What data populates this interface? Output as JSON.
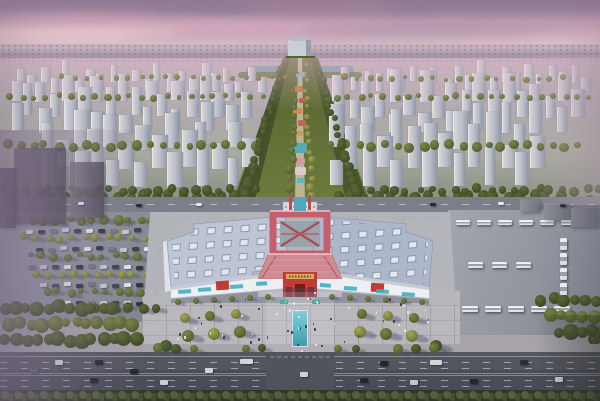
{
  "seed": 7,
  "palette": {
    "skyTop": "#a9859d",
    "sky2": "#c9a4b8",
    "sky3": "#dcb8c6",
    "skyHorizon": "#e9d2d6",
    "cloudDark": "#857c9b",
    "cloudPink": "#e3b0c2",
    "cloudGlow": "#f2dcd8",
    "farCity": "#b2a3b1",
    "horizonBand": "#998a9e",
    "cityBase1": "#b5a8b3",
    "cityBase2": "#a8a9a0",
    "cityBase3": "#82887a",
    "towerLight": "#dcdadc",
    "towerMid": "#b8bcc6",
    "towerDark": "#8f96a6",
    "roadUpper": "#7a7f8a",
    "roadDark": "#4b4f58",
    "laneWhite": "#e8e9ec",
    "plaza": "#bab8bd",
    "plazaLine": "#a2a0a8",
    "sidewalk": "#a9a7ad",
    "wall": "#edeff3",
    "roofL": "#bcc4d6",
    "roofR": "#adb7cb",
    "skylight": "#e2e6ef",
    "skylightEdge": "#7f8798",
    "redFrame": "#c4606c",
    "redRoof": "#cf8a92",
    "redRoofHi": "#eec2c6",
    "redWall": "#c23c36",
    "gold": "#d8ac60",
    "doorDark": "#701d1c",
    "lake": "#6f9cab",
    "pond": "#55a6bb",
    "pool": "#5ec0cf",
    "poolDeep": "#3e9cae",
    "carWhite": "#e6e8ec",
    "carDark": "#272b35",
    "busWhite": "#dfe3e8",
    "hazePurple": "rgba(136,117,149,0.55)",
    "shadow": "rgba(68,73,98,0.4)"
  },
  "scenery": {
    "clouds": [
      {
        "x": -40,
        "y": 0,
        "w": 300,
        "h": 16,
        "c": "cloudDark",
        "o": 0.55
      },
      {
        "x": 180,
        "y": 6,
        "w": 260,
        "h": 12,
        "c": "cloudDark",
        "o": 0.45
      },
      {
        "x": 380,
        "y": -2,
        "w": 240,
        "h": 18,
        "c": "cloudDark",
        "o": 0.5
      },
      {
        "x": 40,
        "y": 20,
        "w": 360,
        "h": 10,
        "c": "cloudPink",
        "o": 0.6
      },
      {
        "x": 300,
        "y": 24,
        "w": 280,
        "h": 10,
        "c": "cloudDark",
        "o": 0.35
      },
      {
        "x": -20,
        "y": 28,
        "w": 200,
        "h": 9,
        "c": "cloudGlow",
        "o": 0.75
      },
      {
        "x": 120,
        "y": 34,
        "w": 420,
        "h": 7,
        "c": "cloudDark",
        "o": 0.3
      },
      {
        "x": 0,
        "y": 12,
        "w": 160,
        "h": 9,
        "c": "cloudPink",
        "o": 0.5
      }
    ],
    "towerClusters": [
      {
        "x": 15,
        "y": 80,
        "cols": 11,
        "rows": 2,
        "dx": 23,
        "dy": 10,
        "w": 8,
        "h": 15
      },
      {
        "x": 338,
        "y": 80,
        "cols": 11,
        "rows": 2,
        "dx": 23,
        "dy": 10,
        "w": 8,
        "h": 15
      },
      {
        "x": 8,
        "y": 100,
        "cols": 9,
        "rows": 3,
        "dx": 27,
        "dy": 15,
        "w": 11,
        "h": 24
      },
      {
        "x": 332,
        "y": 100,
        "cols": 9,
        "rows": 3,
        "dx": 28,
        "dy": 15,
        "w": 11,
        "h": 24
      },
      {
        "x": 40,
        "y": 147,
        "cols": 7,
        "rows": 3,
        "dx": 31,
        "dy": 19,
        "w": 13,
        "h": 32
      },
      {
        "x": 328,
        "y": 147,
        "cols": 7,
        "rows": 3,
        "dx": 31,
        "dy": 19,
        "w": 13,
        "h": 32
      }
    ],
    "cityTreeRows": [
      {
        "x0": 8,
        "y0": 97,
        "n": 22,
        "dx": 12,
        "r": 3,
        "t": "olive"
      },
      {
        "x0": 334,
        "y0": 97,
        "n": 22,
        "dx": 12,
        "r": 3,
        "t": "olive"
      },
      {
        "x0": 4,
        "y0": 146,
        "n": 20,
        "dx": 13,
        "r": 4,
        "t": "olive"
      },
      {
        "x0": 330,
        "y0": 146,
        "n": 20,
        "dx": 13,
        "r": 4,
        "t": "olive"
      },
      {
        "x0": 24,
        "y0": 196,
        "n": 18,
        "dx": 13,
        "r": 5,
        "t": "dark"
      },
      {
        "x0": 336,
        "y0": 196,
        "n": 18,
        "dx": 13,
        "r": 5,
        "t": "dark"
      },
      {
        "x0": 0,
        "y0": 190,
        "n": 22,
        "dx": 12,
        "r": 4,
        "t": "dark"
      },
      {
        "x0": 356,
        "y0": 190,
        "n": 21,
        "dx": 12,
        "r": 4,
        "t": "dark"
      },
      {
        "x0": 148,
        "y0": 216,
        "n": 9,
        "dx": 12,
        "r": 4,
        "t": "olive"
      },
      {
        "x0": 352,
        "y0": 216,
        "n": 9,
        "dx": 12,
        "r": 4,
        "t": "olive"
      },
      {
        "x0": 60,
        "y0": 78,
        "n": 18,
        "dx": 13,
        "r": 2.5,
        "t": "olive"
      },
      {
        "x0": 340,
        "y0": 78,
        "n": 18,
        "dx": 13,
        "r": 2.5,
        "t": "olive"
      }
    ],
    "corridorTreeLines": [
      {
        "x1": 284,
        "y1": 60,
        "x2": 244,
        "y2": 200,
        "n": 22,
        "r0": 2,
        "r1": 5,
        "t": "dark"
      },
      {
        "x1": 316,
        "y1": 60,
        "x2": 358,
        "y2": 200,
        "n": 22,
        "r0": 2,
        "r1": 5,
        "t": "dark"
      },
      {
        "x1": 296,
        "y1": 64,
        "x2": 290,
        "y2": 196,
        "n": 16,
        "r0": 1.5,
        "r1": 4,
        "t": "olive"
      },
      {
        "x1": 305,
        "y1": 64,
        "x2": 312,
        "y2": 196,
        "n": 16,
        "r0": 1.5,
        "r1": 4,
        "t": "yellow"
      },
      {
        "x1": 468,
        "y1": 208,
        "x2": 560,
        "y2": 318,
        "n": 26,
        "r0": 5,
        "r1": 7,
        "t": "dark"
      },
      {
        "x1": 480,
        "y1": 206,
        "x2": 572,
        "y2": 316,
        "n": 24,
        "r0": 4,
        "r1": 6,
        "t": "olive"
      },
      {
        "x1": 590,
        "y1": 200,
        "x2": 594,
        "y2": 340,
        "n": 18,
        "r0": 4,
        "r1": 6,
        "t": "dark"
      }
    ],
    "parkFeatures": [
      {
        "x": 296,
        "y": 72,
        "w": 10,
        "h": 5,
        "c": "#7fb0bc"
      },
      {
        "x": 295,
        "y": 86,
        "w": 8,
        "h": 6,
        "c": "#c27a3e"
      },
      {
        "x": 299,
        "y": 98,
        "w": 7,
        "h": 5,
        "c": "#b55a4a"
      },
      {
        "x": 293,
        "y": 108,
        "w": 9,
        "h": 6,
        "c": "#cc8a50"
      },
      {
        "x": 298,
        "y": 120,
        "w": 8,
        "h": 6,
        "c": "#c06858"
      },
      {
        "x": 294,
        "y": 131,
        "w": 9,
        "h": 5,
        "c": "#cf9a5a"
      },
      {
        "x": 293,
        "y": 143,
        "w": 14,
        "h": 10,
        "c": "#58a8bc"
      },
      {
        "x": 296,
        "y": 158,
        "w": 9,
        "h": 6,
        "c": "#d898a0"
      },
      {
        "x": 295,
        "y": 167,
        "w": 11,
        "h": 8,
        "c": "#e0c8cc"
      },
      {
        "x": 297,
        "y": 178,
        "w": 8,
        "h": 5,
        "c": "#6ab0c0"
      }
    ],
    "awnings": [
      {
        "x": 178,
        "y": 290,
        "w": 13,
        "h": 4,
        "a": -4
      },
      {
        "x": 198,
        "y": 288,
        "w": 13,
        "h": 4,
        "a": -4
      },
      {
        "x": 230,
        "y": 285,
        "w": 13,
        "h": 4,
        "a": -4
      },
      {
        "x": 256,
        "y": 282,
        "w": 11,
        "h": 4,
        "a": -4
      },
      {
        "x": 320,
        "y": 283,
        "w": 11,
        "h": 4,
        "a": 4
      },
      {
        "x": 344,
        "y": 286,
        "w": 13,
        "h": 4,
        "a": 4
      },
      {
        "x": 376,
        "y": 289,
        "w": 13,
        "h": 4,
        "a": 4
      },
      {
        "x": 402,
        "y": 292,
        "w": 13,
        "h": 4,
        "a": 4
      }
    ],
    "plazaTrees": [
      {
        "x": 178,
        "y": 302,
        "r": 3,
        "t": "olive"
      },
      {
        "x": 196,
        "y": 301,
        "r": 3,
        "t": "olive"
      },
      {
        "x": 214,
        "y": 300,
        "r": 3,
        "t": "olive"
      },
      {
        "x": 232,
        "y": 299,
        "r": 3,
        "t": "olive"
      },
      {
        "x": 250,
        "y": 298,
        "r": 3,
        "t": "olive"
      },
      {
        "x": 268,
        "y": 297,
        "r": 3,
        "t": "olive"
      },
      {
        "x": 332,
        "y": 297,
        "r": 3,
        "t": "olive"
      },
      {
        "x": 350,
        "y": 298,
        "r": 3,
        "t": "olive"
      },
      {
        "x": 368,
        "y": 299,
        "r": 3,
        "t": "olive"
      },
      {
        "x": 386,
        "y": 300,
        "r": 3,
        "t": "olive"
      },
      {
        "x": 404,
        "y": 301,
        "r": 3,
        "t": "olive"
      },
      {
        "x": 422,
        "y": 302,
        "r": 3,
        "t": "olive"
      },
      {
        "x": 185,
        "y": 318,
        "r": 5,
        "t": "yellow"
      },
      {
        "x": 210,
        "y": 316,
        "r": 5,
        "t": "olive"
      },
      {
        "x": 236,
        "y": 314,
        "r": 5,
        "t": "yellow"
      },
      {
        "x": 188,
        "y": 336,
        "r": 6,
        "t": "olive"
      },
      {
        "x": 214,
        "y": 334,
        "r": 6,
        "t": "yellow"
      },
      {
        "x": 240,
        "y": 332,
        "r": 6,
        "t": "olive"
      },
      {
        "x": 166,
        "y": 346,
        "r": 6,
        "t": "dark"
      },
      {
        "x": 362,
        "y": 314,
        "r": 5,
        "t": "olive"
      },
      {
        "x": 388,
        "y": 316,
        "r": 5,
        "t": "yellow"
      },
      {
        "x": 414,
        "y": 318,
        "r": 5,
        "t": "olive"
      },
      {
        "x": 360,
        "y": 332,
        "r": 6,
        "t": "yellow"
      },
      {
        "x": 386,
        "y": 334,
        "r": 6,
        "t": "olive"
      },
      {
        "x": 412,
        "y": 336,
        "r": 6,
        "t": "yellow"
      },
      {
        "x": 436,
        "y": 346,
        "r": 6,
        "t": "dark"
      },
      {
        "x": 158,
        "y": 348,
        "r": 5,
        "t": "olive"
      },
      {
        "x": 176,
        "y": 349,
        "r": 5,
        "t": "dark"
      },
      {
        "x": 194,
        "y": 349,
        "r": 4,
        "t": "olive"
      },
      {
        "x": 246,
        "y": 349,
        "r": 4,
        "t": "olive"
      },
      {
        "x": 262,
        "y": 348,
        "r": 4,
        "t": "dark"
      },
      {
        "x": 338,
        "y": 349,
        "r": 4,
        "t": "olive"
      },
      {
        "x": 356,
        "y": 349,
        "r": 4,
        "t": "dark"
      },
      {
        "x": 398,
        "y": 349,
        "r": 5,
        "t": "olive"
      },
      {
        "x": 416,
        "y": 349,
        "r": 5,
        "t": "dark"
      },
      {
        "x": 434,
        "y": 348,
        "r": 5,
        "t": "olive"
      }
    ],
    "cornerTreeRows": [
      {
        "x0": 2,
        "y0": 308,
        "n": 12,
        "dx": 11,
        "r": 6,
        "t": "dark"
      },
      {
        "x0": 8,
        "y0": 324,
        "n": 12,
        "dx": 11,
        "r": 6,
        "t": "olive"
      },
      {
        "x0": 2,
        "y0": 340,
        "n": 13,
        "dx": 11,
        "r": 6,
        "t": "dark"
      },
      {
        "x0": 540,
        "y0": 300,
        "n": 6,
        "dx": 11,
        "r": 6,
        "t": "dark"
      },
      {
        "x0": 548,
        "y0": 316,
        "n": 5,
        "dx": 11,
        "r": 6,
        "t": "olive"
      },
      {
        "x0": 556,
        "y0": 332,
        "n": 5,
        "dx": 11,
        "r": 6,
        "t": "dark"
      }
    ],
    "parkingTreeRows": [
      {
        "x0": 6,
        "y0": 220,
        "n": 14,
        "dx": 12,
        "r": 4,
        "t": "olive"
      },
      {
        "x0": 22,
        "y0": 238,
        "n": 12,
        "dx": 12,
        "r": 3.5,
        "t": "yellow"
      },
      {
        "x0": 28,
        "y0": 256,
        "n": 12,
        "dx": 12,
        "r": 3.5,
        "t": "olive"
      },
      {
        "x0": 34,
        "y0": 274,
        "n": 11,
        "dx": 12,
        "r": 3.5,
        "t": "yellow"
      },
      {
        "x0": 44,
        "y0": 292,
        "n": 10,
        "dx": 12,
        "r": 3.5,
        "t": "olive"
      },
      {
        "x0": 56,
        "y0": 308,
        "n": 9,
        "dx": 12,
        "r": 4,
        "t": "dark"
      }
    ],
    "parkingCarRows": [
      {
        "x0": 26,
        "y0": 228,
        "n": 10,
        "dx": 12
      },
      {
        "x0": 36,
        "y0": 246,
        "n": 11,
        "dx": 12
      },
      {
        "x0": 28,
        "y0": 264,
        "n": 11,
        "dx": 12
      },
      {
        "x0": 40,
        "y0": 282,
        "n": 10,
        "dx": 12
      },
      {
        "x0": 52,
        "y0": 300,
        "n": 8,
        "dx": 12
      }
    ],
    "busRows": [
      {
        "x0": 456,
        "y0": 220,
        "n": 6,
        "dx": 21,
        "dy": 0,
        "w": 14,
        "h": 5
      },
      {
        "x0": 468,
        "y0": 262,
        "n": 3,
        "dx": 24,
        "dy": 0,
        "w": 15,
        "h": 6
      },
      {
        "x0": 462,
        "y0": 306,
        "n": 5,
        "dx": 23,
        "dy": 0,
        "w": 16,
        "h": 6
      },
      {
        "x0": 560,
        "y0": 238,
        "n": 4,
        "dx": 0,
        "dy": 15,
        "w": 7,
        "h": 12
      }
    ],
    "upperRoadCars": [
      {
        "x": 78,
        "y": 202
      },
      {
        "x": 136,
        "y": 204
      },
      {
        "x": 196,
        "y": 203
      },
      {
        "x": 430,
        "y": 203
      },
      {
        "x": 498,
        "y": 202
      },
      {
        "x": 560,
        "y": 204
      }
    ],
    "roadCars": [
      {
        "x": 55,
        "y": 360,
        "c": "#d8dade"
      },
      {
        "x": 95,
        "y": 360,
        "c": "#23262e"
      },
      {
        "x": 240,
        "y": 359,
        "c": "#d8dade",
        "w": 13
      },
      {
        "x": 30,
        "y": 368,
        "c": "#5a6170"
      },
      {
        "x": 130,
        "y": 369,
        "c": "#23262e"
      },
      {
        "x": 205,
        "y": 368,
        "c": "#d8dade"
      },
      {
        "x": 90,
        "y": 378,
        "c": "#23262e"
      },
      {
        "x": 160,
        "y": 380,
        "c": "#d8dade"
      },
      {
        "x": 300,
        "y": 372,
        "c": "#d8dade"
      },
      {
        "x": 380,
        "y": 361,
        "c": "#23262e"
      },
      {
        "x": 430,
        "y": 360,
        "c": "#d8dade",
        "w": 12
      },
      {
        "x": 520,
        "y": 360,
        "c": "#2a2e38"
      },
      {
        "x": 360,
        "y": 378,
        "c": "#23262e"
      },
      {
        "x": 410,
        "y": 380,
        "c": "#cfd2d8"
      },
      {
        "x": 470,
        "y": 379,
        "c": "#23262e"
      },
      {
        "x": 555,
        "y": 377,
        "c": "#d8dade"
      }
    ],
    "leftBuildings": [
      {
        "x": 14,
        "y": 148,
        "w": 52,
        "h": 76,
        "c": "#6a6270"
      },
      {
        "x": 70,
        "y": 162,
        "w": 34,
        "h": 56,
        "c": "#7b7380"
      },
      {
        "x": 0,
        "y": 168,
        "w": 16,
        "h": 60,
        "c": "#5e5766"
      }
    ],
    "rightBuildings": [
      {
        "x": 544,
        "y": 203,
        "w": 26,
        "h": 17,
        "c": "#8d8f98"
      },
      {
        "x": 571,
        "y": 208,
        "w": 27,
        "h": 19,
        "c": "#83858f"
      },
      {
        "x": 520,
        "y": 199,
        "w": 20,
        "h": 13,
        "c": "#90929b"
      }
    ],
    "peopleRegions": [
      {
        "x": 170,
        "y": 297,
        "w": 260,
        "h": 48,
        "n": 42
      },
      {
        "x": 283,
        "y": 290,
        "w": 34,
        "h": 60,
        "n": 16
      }
    ]
  }
}
